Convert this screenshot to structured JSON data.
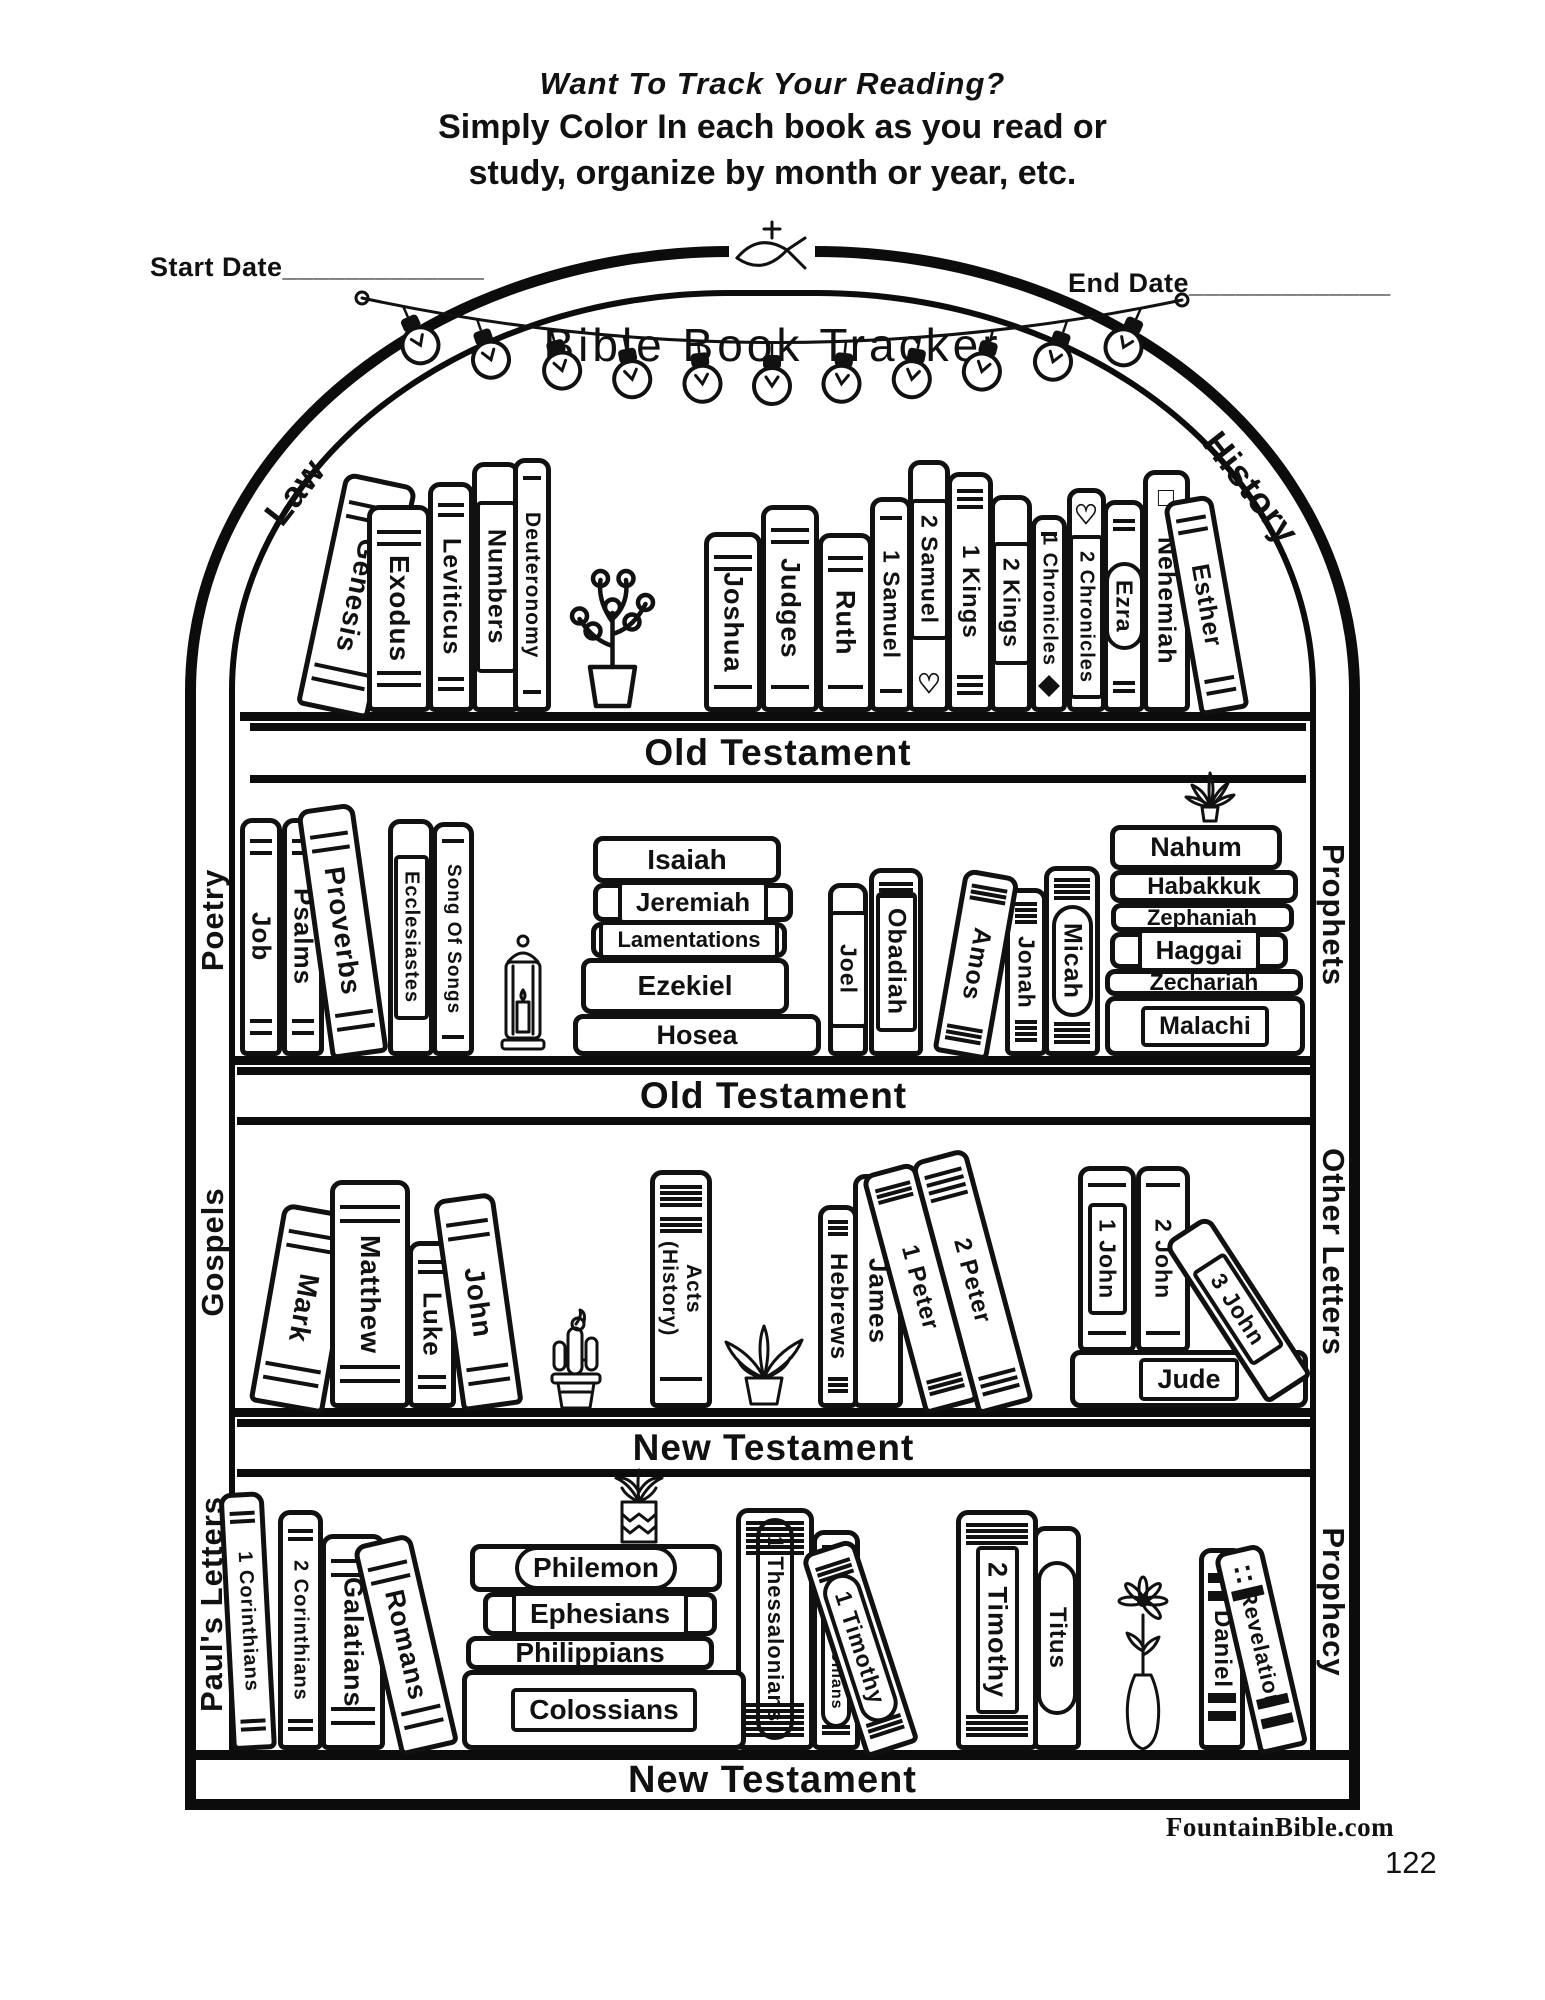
{
  "header": {
    "line1": "Want To Track Your Reading?",
    "line2": "Simply Color In each book as you read or",
    "line3": "study, organize by month or year, etc.",
    "start_date": "Start Date_____________",
    "end_date": "End Date_____________"
  },
  "tracker": {
    "title": "Bible  Book Tracker",
    "top_icon": "ichthys-cross-icon",
    "garland_icon": "string-lights"
  },
  "section_labels": {
    "law": "Law",
    "history": "History",
    "poetry": "Poetry",
    "prophets": "Prophets",
    "gospels": "Gospels",
    "other_letters": "Other Letters",
    "pauls_letters": "Paul's Letters",
    "prophecy": "Prophecy"
  },
  "bands": [
    {
      "label": "Old Testament"
    },
    {
      "label": "Old Testament"
    },
    {
      "label": "New Testament"
    },
    {
      "label": "New Testament"
    }
  ],
  "shelves": [
    {
      "name": "law-history",
      "books": [
        {
          "label": "Genesis"
        },
        {
          "label": "Exodus"
        },
        {
          "label": "Leviticus"
        },
        {
          "label": "Numbers"
        },
        {
          "label": "Deuteronomy"
        },
        {
          "label": "Joshua"
        },
        {
          "label": "Judges"
        },
        {
          "label": "Ruth"
        },
        {
          "label": "1 Samuel"
        },
        {
          "label": "2 Samuel",
          "icon": "heart-bottom"
        },
        {
          "label": "1 Kings"
        },
        {
          "label": "2 Kings"
        },
        {
          "label": "1 Chronicles",
          "icon": "diamond-bottom"
        },
        {
          "label": "2 Chronicles",
          "icon": "heart-top"
        },
        {
          "label": "Ezra"
        },
        {
          "label": "Nehemiah",
          "icon": "square-top"
        },
        {
          "label": "Esther"
        }
      ]
    },
    {
      "name": "poetry-prophets",
      "books": [
        {
          "label": "Job"
        },
        {
          "label": "Psalms"
        },
        {
          "label": "Proverbs"
        },
        {
          "label": "Ecclesiastes"
        },
        {
          "label": "Song Of Songs"
        },
        {
          "label": "Joel"
        },
        {
          "label": "Obadiah"
        },
        {
          "label": "Amos"
        },
        {
          "label": "Jonah"
        },
        {
          "label": "Micah"
        }
      ],
      "stacks": [
        {
          "rows": [
            {
              "label": "Isaiah"
            },
            {
              "label": "Jeremiah"
            },
            {
              "label": "Lamentations"
            },
            {
              "label": "Ezekiel"
            },
            {
              "label": "Hosea"
            }
          ]
        },
        {
          "rows": [
            {
              "label": "Nahum"
            },
            {
              "label": "Habakkuk"
            },
            {
              "label": "Zephaniah"
            },
            {
              "label": "Haggai"
            },
            {
              "label": "Zechariah"
            },
            {
              "label": "Malachi"
            }
          ]
        }
      ]
    },
    {
      "name": "gospels-other-letters",
      "books": [
        {
          "label": "Mark"
        },
        {
          "label": "Matthew"
        },
        {
          "label": "Luke"
        },
        {
          "label": "John"
        },
        {
          "label": "Acts",
          "label2": "(History)"
        },
        {
          "label": "Hebrews"
        },
        {
          "label": "James",
          "icon": "square-top"
        },
        {
          "label": "1 Peter"
        },
        {
          "label": "2 Peter"
        },
        {
          "label": "1 John"
        },
        {
          "label": "2 John"
        },
        {
          "label": "3 John"
        },
        {
          "label": "Jude"
        }
      ]
    },
    {
      "name": "pauls-letters-prophecy",
      "books": [
        {
          "label": "1 Corinthians"
        },
        {
          "label": "2 Corinthians"
        },
        {
          "label": "Galatians"
        },
        {
          "label": "Romans"
        },
        {
          "label": "1 Thessalonians"
        },
        {
          "label": "2 Thessalonians"
        },
        {
          "label": "1 Timothy"
        },
        {
          "label": "2 Timothy"
        },
        {
          "label": "Titus"
        },
        {
          "label": "Daniel"
        },
        {
          "label": "Revelation",
          "icon": "dots-top"
        }
      ],
      "stacks": [
        {
          "rows": [
            {
              "label": "Philemon"
            },
            {
              "label": "Ephesians"
            },
            {
              "label": "Philippians"
            },
            {
              "label": "Colossians"
            }
          ]
        }
      ]
    }
  ],
  "decor_icons": [
    "potted-plant",
    "lantern",
    "succulent",
    "cactus",
    "houseplant",
    "sprout-plant",
    "flower-vase",
    "string-lights",
    "ichthys-cross"
  ],
  "footer": {
    "site": "FountainBible.com",
    "page_number": "122"
  }
}
